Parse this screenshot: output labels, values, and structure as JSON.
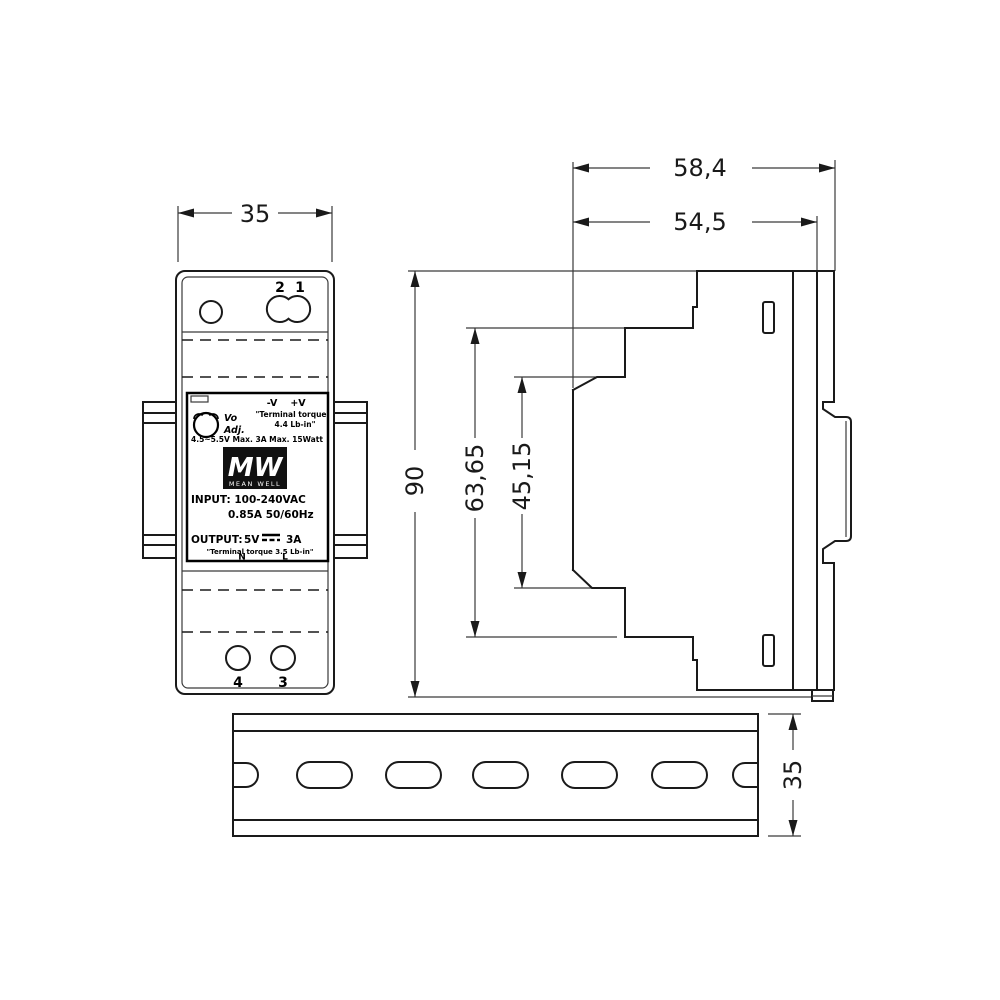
{
  "colors": {
    "line": "#1a1a1a",
    "background": "#ffffff",
    "logo_bg": "#111111"
  },
  "dimensions": {
    "front_width": "35",
    "overall_depth": "58,4",
    "body_depth": "54,5",
    "overall_height": "90",
    "mid_height": "63,65",
    "front_height": "45,15",
    "rail_width": "35"
  },
  "front_view": {
    "terminal_top_2": "2",
    "terminal_top_1": "1",
    "terminal_bottom_4": "4",
    "terminal_bottom_3": "3",
    "label": {
      "adjust_line1": "Vo",
      "adjust_line2": "Adj.",
      "polarity_neg": "-V",
      "polarity_pos": "+V",
      "torque_top_line1": "\"Terminal torque",
      "torque_top_line2": "4.4 Lb-in\"",
      "specs": "4.5~5.5V  Max. 3A  Max. 15Watt",
      "logo_mark": "MW",
      "logo_name": "MEAN WELL",
      "input_line1": "INPUT: 100-240VAC",
      "input_line2": "0.85A  50/60Hz",
      "output_label": "OUTPUT:",
      "output_voltage": "5V",
      "output_current": "3A",
      "torque_bottom": "\"Terminal torque 3.5 Lb-in\"",
      "terminal_n": "N",
      "terminal_l": "L"
    }
  }
}
